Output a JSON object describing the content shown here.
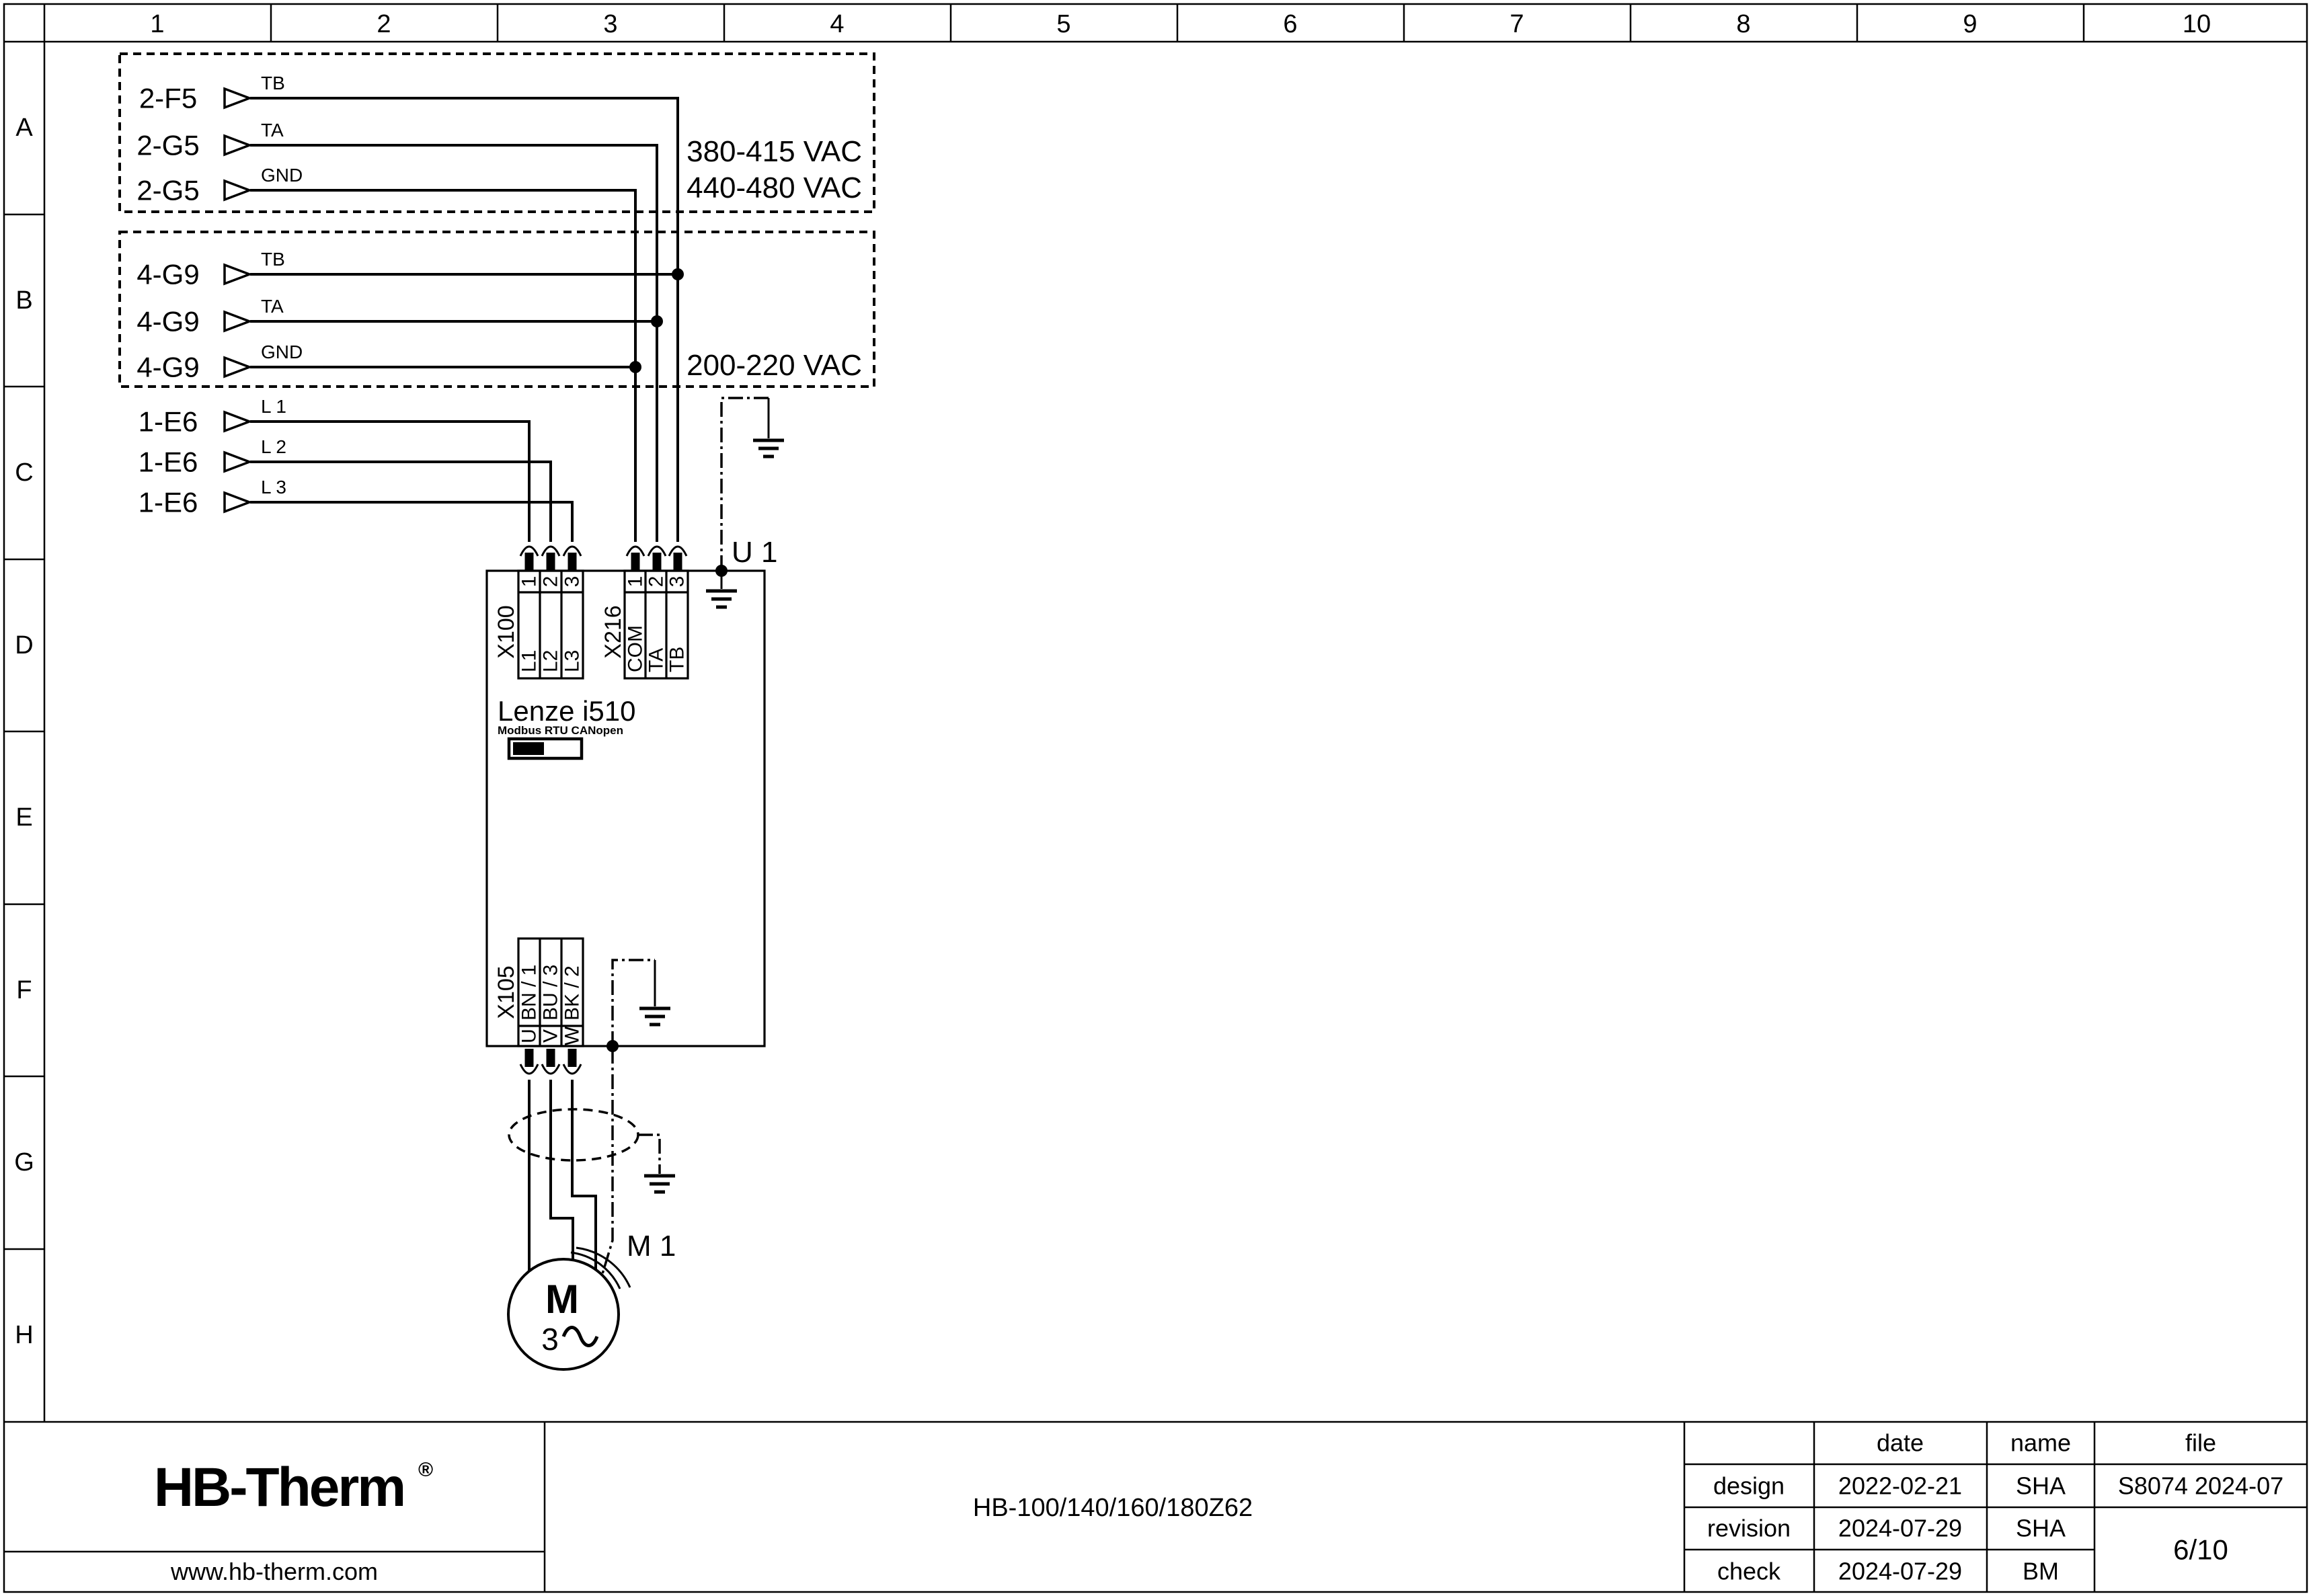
{
  "ruler": {
    "columns": [
      "1",
      "2",
      "3",
      "4",
      "5",
      "6",
      "7",
      "8",
      "9",
      "10"
    ],
    "rows": [
      "A",
      "B",
      "C",
      "D",
      "E",
      "F",
      "G",
      "H"
    ]
  },
  "box_a": {
    "rows": [
      {
        "ref": "2-F5",
        "signal": "TB"
      },
      {
        "ref": "2-G5",
        "signal": "TA"
      },
      {
        "ref": "2-G5",
        "signal": "GND"
      }
    ],
    "voltage_lines": [
      "380-415 VAC",
      "440-480 VAC"
    ]
  },
  "box_b": {
    "rows": [
      {
        "ref": "4-G9",
        "signal": "TB"
      },
      {
        "ref": "4-G9",
        "signal": "TA"
      },
      {
        "ref": "4-G9",
        "signal": "GND"
      }
    ],
    "voltage_lines": [
      "200-220 VAC"
    ]
  },
  "mains": {
    "rows": [
      {
        "ref": "1-E6",
        "signal": "L 1"
      },
      {
        "ref": "1-E6",
        "signal": "L 2"
      },
      {
        "ref": "1-E6",
        "signal": "L 3"
      }
    ]
  },
  "drive": {
    "designator": "U 1",
    "name": "Lenze i510",
    "comm": "Modbus RTU CANopen",
    "x100": {
      "name": "X100",
      "pins": [
        "1",
        "2",
        "3"
      ],
      "wires": [
        "L1",
        "L2",
        "L3"
      ]
    },
    "x216": {
      "name": "X216",
      "pins": [
        "1",
        "2",
        "3"
      ],
      "wires": [
        "COM",
        "TA",
        "TB"
      ]
    },
    "x105": {
      "name": "X105",
      "pins": [
        "U",
        "V",
        "W"
      ],
      "wires": [
        "BN / 1",
        "BU / 3",
        "BK / 2"
      ]
    }
  },
  "motor": {
    "designator": "M 1",
    "letter": "M",
    "phase": "3"
  },
  "title_block": {
    "company": "HB-Therm",
    "registered": "®",
    "website": "www.hb-therm.com",
    "drawing_title": "HB-100/140/160/180Z62",
    "col_headers": {
      "date": "date",
      "name": "name",
      "file": "file"
    },
    "rows": [
      {
        "label": "design",
        "date": "2022-02-21",
        "name": "SHA"
      },
      {
        "label": "revision",
        "date": "2024-07-29",
        "name": "SHA"
      },
      {
        "label": "check",
        "date": "2024-07-29",
        "name": "BM"
      }
    ],
    "file_number": "S8074 2024-07",
    "page": "6/10"
  },
  "colors": {
    "line": "#000000",
    "logo": "#232c56",
    "background": "#ffffff"
  }
}
